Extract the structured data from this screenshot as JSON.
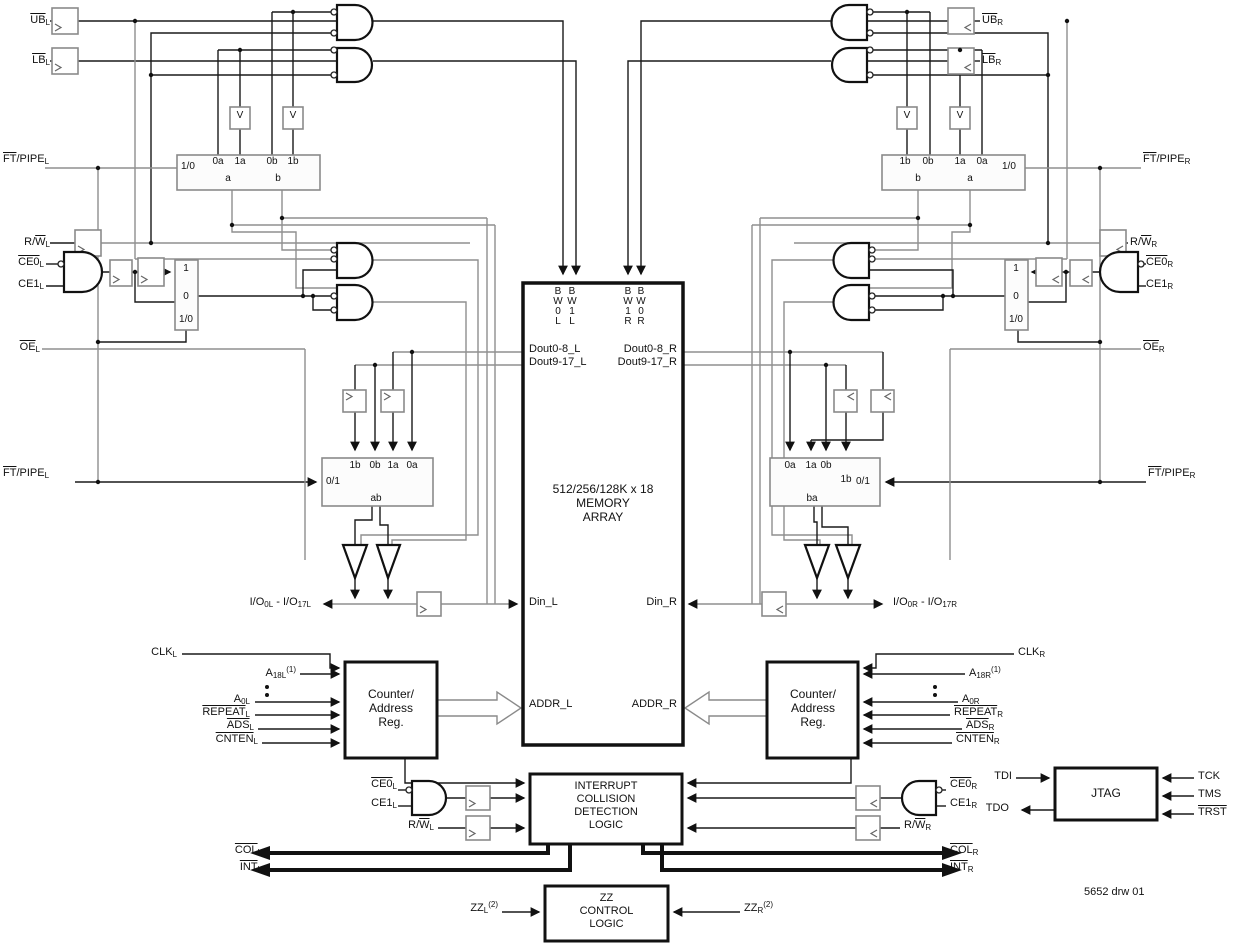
{
  "colors": {
    "wire_black": "#1a1a1a",
    "wire_gray": "#8f8f8f",
    "background": "#ffffff"
  },
  "rich": {
    "ub_l": [
      {
        "t": "UB",
        "ov": true
      },
      {
        "t": "L",
        "sub": true
      }
    ],
    "lb_l": [
      {
        "t": "LB",
        "ov": true
      },
      {
        "t": "L",
        "sub": true
      }
    ],
    "ub_r": [
      {
        "t": "UB",
        "ov": true
      },
      {
        "t": "R",
        "sub": true
      }
    ],
    "lb_r": [
      {
        "t": "LB",
        "ov": true
      },
      {
        "t": "R",
        "sub": true
      }
    ],
    "ftpipe_l": [
      {
        "t": "FT",
        "ov": true
      },
      {
        "t": "/PIPE"
      },
      {
        "t": "L",
        "sub": true
      }
    ],
    "ftpipe_r": [
      {
        "t": "FT",
        "ov": true
      },
      {
        "t": "/PIPE"
      },
      {
        "t": "R",
        "sub": true
      }
    ],
    "rw_l": [
      {
        "t": "R/"
      },
      {
        "t": "W",
        "ov": true
      },
      {
        "t": "L",
        "sub": true
      }
    ],
    "rw_r": [
      {
        "t": "R/"
      },
      {
        "t": "W",
        "ov": true
      },
      {
        "t": "R",
        "sub": true
      }
    ],
    "ce0_l": [
      {
        "t": "CE0",
        "ov": true
      },
      {
        "t": "L",
        "sub": true
      }
    ],
    "ce1_l": [
      {
        "t": "CE1"
      },
      {
        "t": "L",
        "sub": true
      }
    ],
    "ce0_r": [
      {
        "t": "CE0",
        "ov": true
      },
      {
        "t": "R",
        "sub": true
      }
    ],
    "ce1_r": [
      {
        "t": "CE1"
      },
      {
        "t": "R",
        "sub": true
      }
    ],
    "oe_l": [
      {
        "t": "OE",
        "ov": true
      },
      {
        "t": "L",
        "sub": true
      }
    ],
    "oe_r": [
      {
        "t": "OE",
        "ov": true
      },
      {
        "t": "R",
        "sub": true
      }
    ],
    "io_l": [
      {
        "t": "I/O"
      },
      {
        "t": "0L",
        "sub": true
      },
      {
        "t": " - I/O"
      },
      {
        "t": "17L",
        "sub": true
      }
    ],
    "io_r": [
      {
        "t": "I/O"
      },
      {
        "t": "0R",
        "sub": true
      },
      {
        "t": " - I/O"
      },
      {
        "t": "17R",
        "sub": true
      }
    ],
    "clk_l": [
      {
        "t": "CLK"
      },
      {
        "t": "L",
        "sub": true
      }
    ],
    "clk_r": [
      {
        "t": "CLK"
      },
      {
        "t": "R",
        "sub": true
      }
    ],
    "a18_l": [
      {
        "t": "A"
      },
      {
        "t": "18L",
        "sub": true
      },
      {
        "t": "(1)",
        "sup": true
      }
    ],
    "a18_r": [
      {
        "t": "A"
      },
      {
        "t": "18R",
        "sub": true
      },
      {
        "t": "(1)",
        "sup": true
      }
    ],
    "a0_l": [
      {
        "t": "A"
      },
      {
        "t": "0L",
        "sub": true
      }
    ],
    "a0_r": [
      {
        "t": "A"
      },
      {
        "t": "0R",
        "sub": true
      }
    ],
    "repeat_l": [
      {
        "t": "REPEAT",
        "ov": true
      },
      {
        "t": "L",
        "sub": true
      }
    ],
    "repeat_r": [
      {
        "t": "REPEAT",
        "ov": true
      },
      {
        "t": "R",
        "sub": true
      }
    ],
    "ads_l": [
      {
        "t": "ADS",
        "ov": true
      },
      {
        "t": "L",
        "sub": true
      }
    ],
    "ads_r": [
      {
        "t": "ADS",
        "ov": true
      },
      {
        "t": "R",
        "sub": true
      }
    ],
    "cnten_l": [
      {
        "t": "CNTEN",
        "ov": true
      },
      {
        "t": "L",
        "sub": true
      }
    ],
    "cnten_r": [
      {
        "t": "CNTEN",
        "ov": true
      },
      {
        "t": "R",
        "sub": true
      }
    ],
    "col_l": [
      {
        "t": "COL",
        "ov": true
      },
      {
        "t": "L",
        "sub": true
      }
    ],
    "col_r": [
      {
        "t": "COL",
        "ov": true
      },
      {
        "t": "R",
        "sub": true
      }
    ],
    "int_l": [
      {
        "t": "INT",
        "ov": true
      },
      {
        "t": "L",
        "sub": true
      }
    ],
    "int_r": [
      {
        "t": "INT",
        "ov": true
      },
      {
        "t": "R",
        "sub": true
      }
    ],
    "zz_l": [
      {
        "t": "ZZ"
      },
      {
        "t": "L",
        "sub": true
      },
      {
        "t": "(2)",
        "sup": true
      }
    ],
    "zz_r": [
      {
        "t": "ZZ"
      },
      {
        "t": "R",
        "sub": true
      },
      {
        "t": "(2)",
        "sup": true
      }
    ],
    "trst": [
      {
        "t": "TRST",
        "ov": true
      }
    ]
  },
  "text": {
    "v": "V",
    "one": "1",
    "zero": "0",
    "sel10": "1/0",
    "sel01": "0/1",
    "p0a": "0a",
    "p1a": "1a",
    "p0b": "0b",
    "p1b": "1b",
    "pa": "a",
    "pb": "b",
    "pab": "ab",
    "pba": "ba",
    "counter": "Counter/\nAddress\nReg.",
    "memory": "512/256/128K x 18\nMEMORY\nARRAY",
    "interrupt": "INTERRUPT\nCOLLISION\nDETECTION\nLOGIC",
    "zzbox": "ZZ\nCONTROL\nLOGIC",
    "jtag": "JTAG",
    "tdi": "TDI",
    "tdo": "TDO",
    "tck": "TCK",
    "tms": "TMS",
    "bw0l": "B\nW\n0\nL",
    "bw1l": "B\nW\n1\nL",
    "bw1r": "B\nW\n1\nR",
    "bw0r": "B\nW\n0\nR",
    "dout08_l": "Dout0-8_L",
    "dout917_l": "Dout9-17_L",
    "dout08_r": "Dout0-8_R",
    "dout917_r": "Dout9-17_R",
    "din_l": "Din_L",
    "din_r": "Din_R",
    "addr_l": "ADDR_L",
    "addr_r": "ADDR_R",
    "footer": "5652 drw 01"
  }
}
